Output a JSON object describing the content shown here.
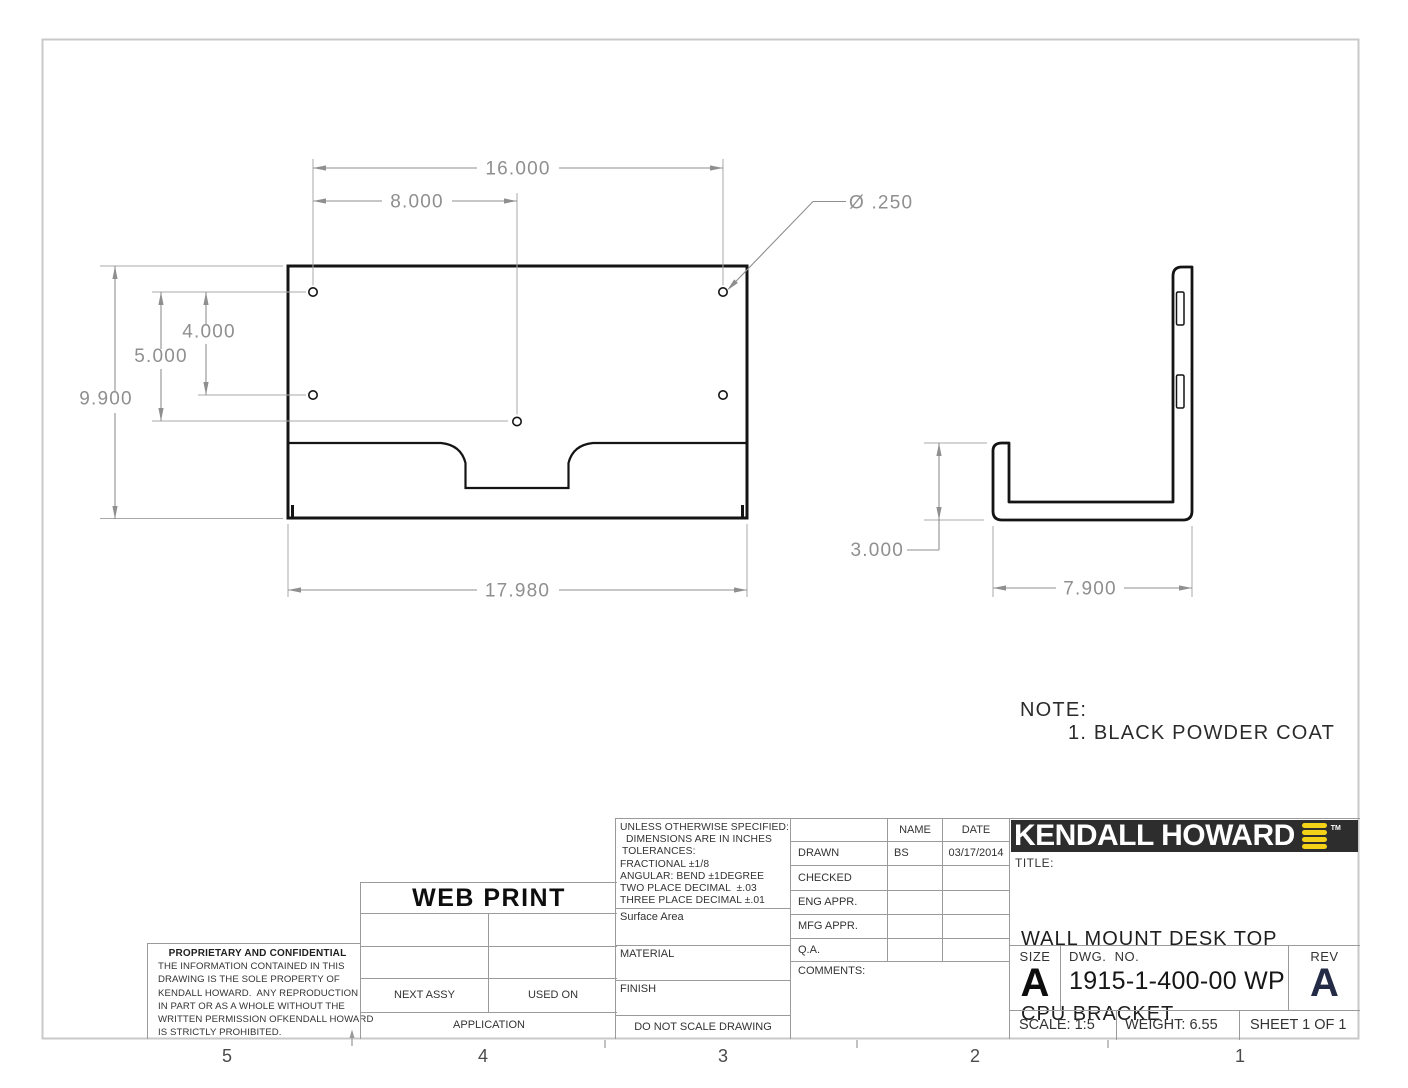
{
  "sheet": {
    "zone_labels": [
      "5",
      "4",
      "3",
      "2",
      "1"
    ]
  },
  "note": {
    "label": "NOTE:",
    "item_1": "1. BLACK POWDER COAT"
  },
  "dimensions": {
    "front": {
      "hole_span": "16.000",
      "hole_half_span": "8.000",
      "hole_diameter": "Ø .250",
      "hole_offset_4": "4.000",
      "hole_offset_5": "5.000",
      "height": "9.900",
      "width": "17.980"
    },
    "side": {
      "lip_height": "3.000",
      "depth": "7.900"
    }
  },
  "web_print_stamp": "WEB PRINT",
  "application_table": {
    "next_assy": "NEXT ASSY",
    "used_on": "USED ON",
    "application": "APPLICATION"
  },
  "proprietary": {
    "heading": "PROPRIETARY AND CONFIDENTIAL",
    "body_lines": [
      "THE INFORMATION CONTAINED IN THIS",
      "DRAWING IS THE SOLE PROPERTY OF",
      "KENDALL HOWARD.  ANY REPRODUCTION",
      "IN PART OR AS A WHOLE WITHOUT THE",
      "WRITTEN PERMISSION OFKENDALL HOWARD",
      "IS STRICTLY PROHIBITED."
    ]
  },
  "spec_block": {
    "lines": [
      "UNLESS OTHERWISE SPECIFIED:",
      "DIMENSIONS ARE IN INCHES",
      "TOLERANCES:",
      "FRACTIONAL ±1/8",
      "ANGULAR: BEND ±1DEGREE",
      "TWO PLACE DECIMAL  ±.03",
      "THREE PLACE DECIMAL ±.01"
    ],
    "surface_area_label": "Surface Area",
    "material_label": "MATERIAL",
    "finish_label": "FINISH",
    "do_not_scale": "DO NOT SCALE DRAWING"
  },
  "approval_table": {
    "name_header": "NAME",
    "date_header": "DATE",
    "rows": [
      {
        "label": "DRAWN",
        "name": "BS",
        "date": "03/17/2014"
      },
      {
        "label": "CHECKED",
        "name": "",
        "date": ""
      },
      {
        "label": "ENG APPR.",
        "name": "",
        "date": ""
      },
      {
        "label": "MFG APPR.",
        "name": "",
        "date": ""
      },
      {
        "label": "Q.A.",
        "name": "",
        "date": ""
      }
    ],
    "comments_label": "COMMENTS:"
  },
  "title_block": {
    "brand": "KENDALL HOWARD",
    "trademark": "TM",
    "title_label": "TITLE:",
    "title_line_1": "WALL MOUNT DESK TOP",
    "title_line_2": "CPU BRACKET",
    "size_label": "SIZE",
    "size_value": "A",
    "dwg_label": "DWG.  NO.",
    "dwg_number": "1915-1-400-00 WP",
    "rev_label": "REV",
    "rev_value": "A",
    "scale": "SCALE: 1:5",
    "weight": "WEIGHT: 6.55",
    "sheet": "SHEET 1 OF 1"
  },
  "colors": {
    "logo_background": "#2d2d2d",
    "logo_accent_yellow": "#f3d117",
    "rev_navy": "#232b47",
    "dimension_gray": "#8f8f8f"
  }
}
